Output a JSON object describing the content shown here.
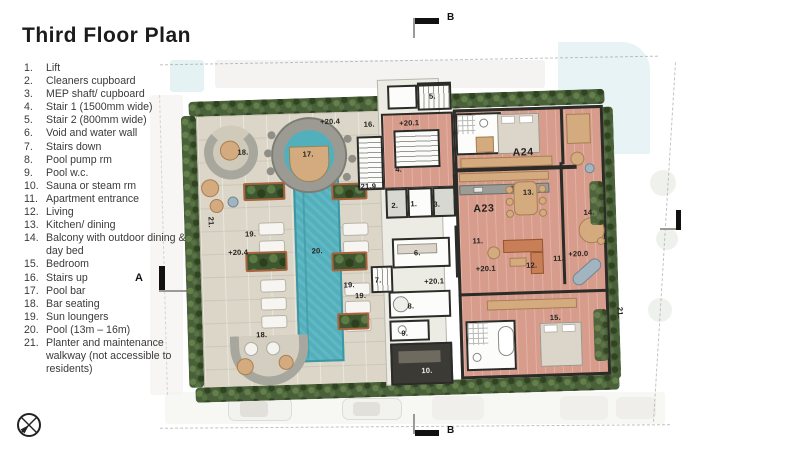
{
  "title": "Third Floor Plan",
  "legend": {
    "items": [
      {
        "num": "1.",
        "text": "Lift"
      },
      {
        "num": "2.",
        "text": "Cleaners cupboard"
      },
      {
        "num": "3.",
        "text": "MEP shaft/ cupboard"
      },
      {
        "num": "4.",
        "text": "Stair 1 (1500mm wide)"
      },
      {
        "num": "5.",
        "text": "Stair 2 (800mm wide)"
      },
      {
        "num": "6.",
        "text": "Void and water wall"
      },
      {
        "num": "7.",
        "text": "Stairs down"
      },
      {
        "num": "8.",
        "text": "Pool pump rm"
      },
      {
        "num": "9.",
        "text": "Pool w.c."
      },
      {
        "num": "10.",
        "text": "Sauna or steam rm"
      },
      {
        "num": "11.",
        "text": "Apartment entrance"
      },
      {
        "num": "12.",
        "text": "Living"
      },
      {
        "num": "13.",
        "text": "Kitchen/ dining"
      },
      {
        "num": "14.",
        "text": "Balcony with outdoor dining & day bed"
      },
      {
        "num": "15.",
        "text": "Bedroom"
      },
      {
        "num": "16.",
        "text": "Stairs up"
      },
      {
        "num": "17.",
        "text": "Pool bar"
      },
      {
        "num": "18.",
        "text": "Bar seating"
      },
      {
        "num": "19.",
        "text": "Sun loungers"
      },
      {
        "num": "20.",
        "text": "Pool (13m – 16m)"
      },
      {
        "num": "21.",
        "text": "Planter and maintenance walkway (not accessible to residents)"
      }
    ]
  },
  "markers": {
    "a": "A",
    "b": "B"
  },
  "plan": {
    "labels": [
      {
        "text": "18.",
        "x": 63,
        "y": 72
      },
      {
        "text": "17.",
        "x": 128,
        "y": 76
      },
      {
        "text": "+20.4",
        "x": 151,
        "y": 44
      },
      {
        "text": "16.",
        "x": 190,
        "y": 48
      },
      {
        "text": "+20.1",
        "x": 230,
        "y": 48
      },
      {
        "text": "5.",
        "x": 254,
        "y": 22
      },
      {
        "text": "4.",
        "x": 218,
        "y": 94
      },
      {
        "text": "+21.9",
        "x": 185,
        "y": 110
      },
      {
        "text": "2.",
        "x": 213,
        "y": 130
      },
      {
        "text": "1.",
        "x": 232,
        "y": 129
      },
      {
        "text": "3.",
        "x": 255,
        "y": 130
      },
      {
        "text": "21.",
        "x": 29,
        "y": 141,
        "v": 1
      },
      {
        "text": "19.",
        "x": 68,
        "y": 154
      },
      {
        "text": "+20.4",
        "x": 55,
        "y": 172
      },
      {
        "text": "20.",
        "x": 134,
        "y": 173
      },
      {
        "text": "6.",
        "x": 234,
        "y": 178
      },
      {
        "text": "7.",
        "x": 194,
        "y": 204
      },
      {
        "text": "+20.1",
        "x": 250,
        "y": 207
      },
      {
        "text": "19.",
        "x": 165,
        "y": 208
      },
      {
        "text": "19.",
        "x": 176,
        "y": 219
      },
      {
        "text": "8.",
        "x": 226,
        "y": 231
      },
      {
        "text": "9.",
        "x": 219,
        "y": 258
      },
      {
        "text": "10.",
        "x": 240,
        "y": 296,
        "light": 1
      },
      {
        "text": "18.",
        "x": 76,
        "y": 255
      },
      {
        "text": "A24",
        "x": 343,
        "y": 81,
        "unit": 1
      },
      {
        "text": "13.",
        "x": 347,
        "y": 121
      },
      {
        "text": "A23",
        "x": 302,
        "y": 136,
        "unit": 1
      },
      {
        "text": "14.",
        "x": 407,
        "y": 143
      },
      {
        "text": "11.",
        "x": 295,
        "y": 168
      },
      {
        "text": "+20.1",
        "x": 302,
        "y": 196
      },
      {
        "text": "12.",
        "x": 348,
        "y": 194
      },
      {
        "text": "11.",
        "x": 375,
        "y": 188
      },
      {
        "text": "+20.0",
        "x": 395,
        "y": 184
      },
      {
        "text": "15.",
        "x": 370,
        "y": 247
      },
      {
        "text": "21.",
        "x": 435,
        "y": 244,
        "v": 1
      }
    ]
  },
  "colors": {
    "pool": "#52b0bd",
    "pool-edge": "#3d96a4",
    "apt": "#d79c8b",
    "deck": "#dbd6c7",
    "planter": "#49603a",
    "wall": "#2b2b28"
  }
}
